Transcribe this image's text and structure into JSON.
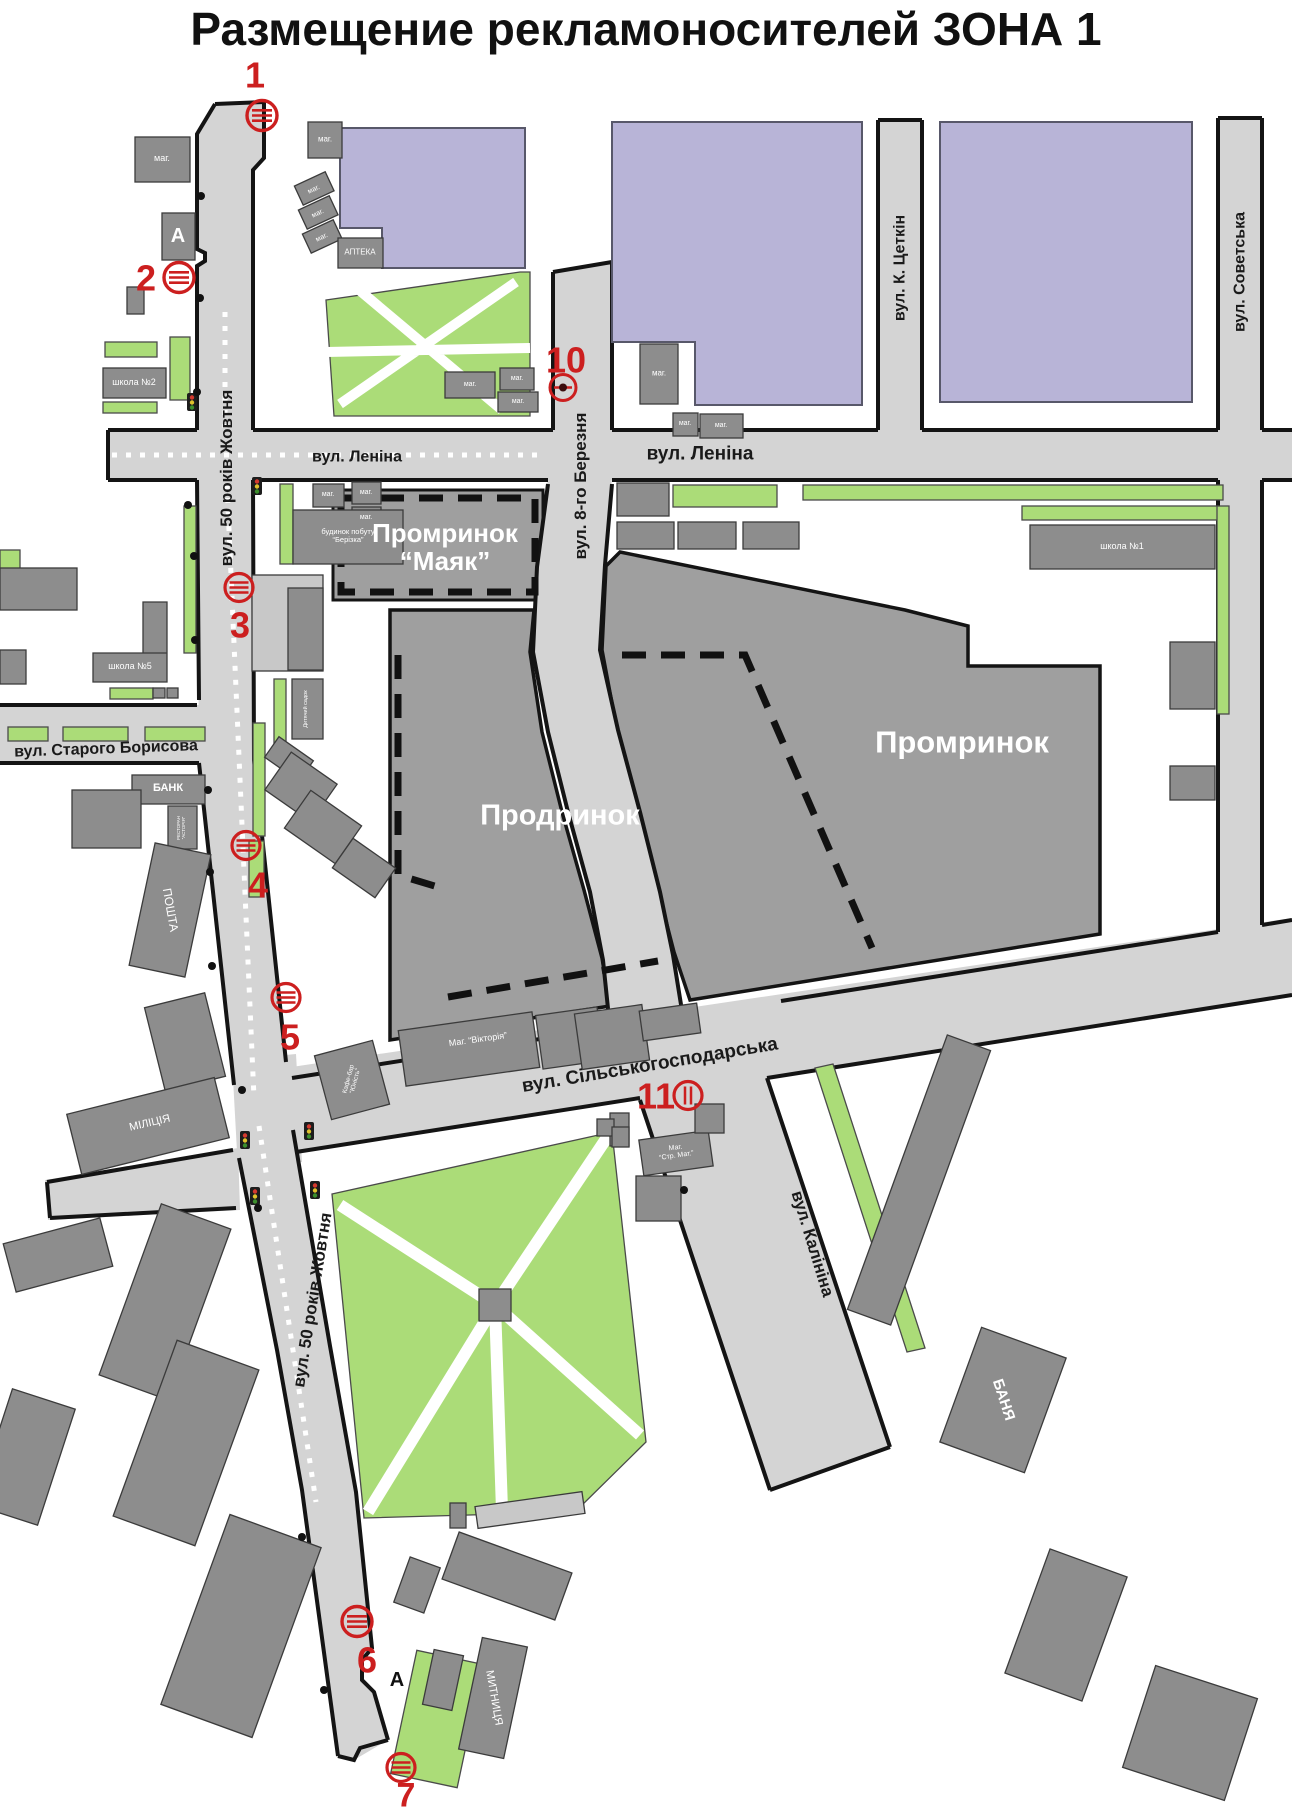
{
  "title": "Размещение рекламоносителей ЗОНА 1",
  "streets": {
    "rokiv50": "вул. 50 років Жовтня",
    "lenina": "вул. Леніна",
    "berezna8": "вул. 8-го Березня",
    "tsetkin": "вул. К. Цеткін",
    "sovetska": "вул. Советська",
    "boryssova": "вул. Старого Борисова",
    "silhosp": "вул. Сільськогосподарська",
    "kalinina": "вул. Калініна"
  },
  "areas": {
    "mayak_line1": "Промринок",
    "mayak_line2": "“Маяк”",
    "prodrynok": "Продринок",
    "promrynok": "Промринок"
  },
  "buildings": {
    "mag": "маг.",
    "apteka": "АПТЕКА",
    "school1": "школа №1",
    "school2": "школа №2",
    "school5": "школа №5",
    "bank": "БАНК",
    "restoran_line1": "РЕСТОРАН",
    "restoran_line2": "“АСТОРІЯ”",
    "poshta": "ПОШТА",
    "militsia": "МІЛІЦІЯ",
    "dytsadok": "Дитячий садок",
    "berizka_line1": "будинок побуту",
    "berizka_line2": "“Берізка”",
    "kafe_line1": "Кафе-бар",
    "kafe_line2": "“Юність”",
    "viktoria": "Маг.  “Вікторія”",
    "strmat_line1": "Маг.",
    "strmat_line2": "“Стр. Мат.”",
    "banya": "БАНЯ",
    "mytnytsia": "МИТНИЦЯ",
    "bus_stop": "А"
  },
  "markers": [
    {
      "number": "1"
    },
    {
      "number": "2"
    },
    {
      "number": "3"
    },
    {
      "number": "4"
    },
    {
      "number": "5"
    },
    {
      "number": "6"
    },
    {
      "number": "7"
    },
    {
      "number": "10"
    },
    {
      "number": "11"
    }
  ]
}
